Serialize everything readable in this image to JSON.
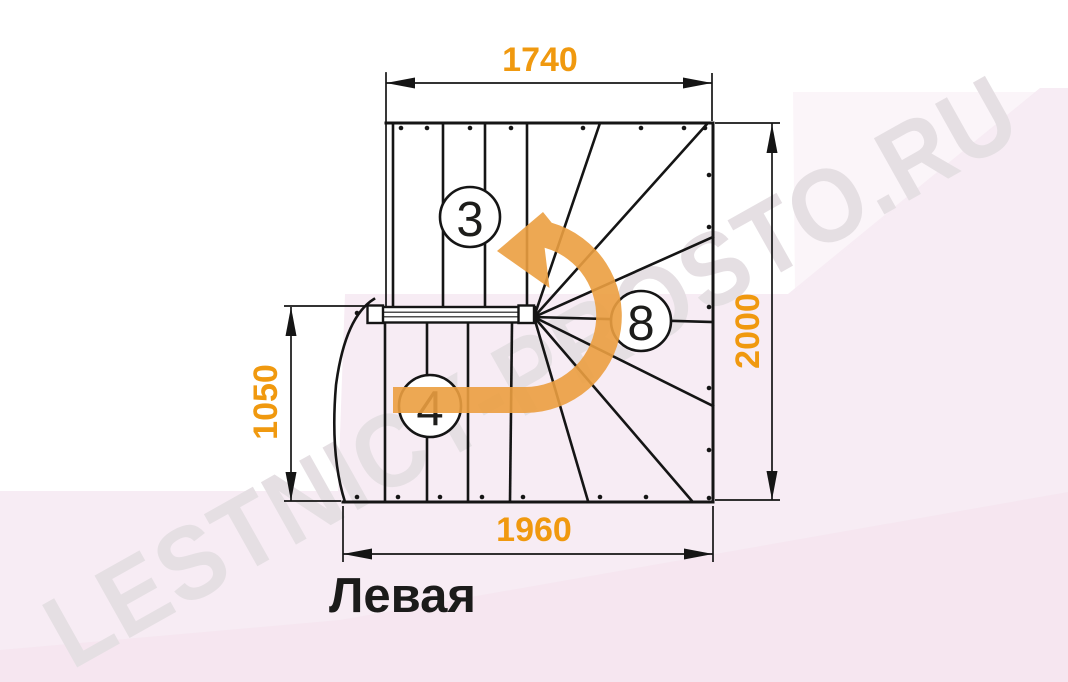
{
  "title": "Левая",
  "watermark": "LESTNICY-PROSTO.RU",
  "dimensions": {
    "top": "1740",
    "right": "2000",
    "left": "1050",
    "bottom": "1960"
  },
  "steps": {
    "upper_flight": "3",
    "winders": "8",
    "lower_flight": "4"
  },
  "colors": {
    "dimension_text": "#f0990f",
    "arrow": "#eb9e40",
    "lines": "#151515",
    "background_pink": "#f7ecf4",
    "watermark": "#e5dfe3"
  }
}
